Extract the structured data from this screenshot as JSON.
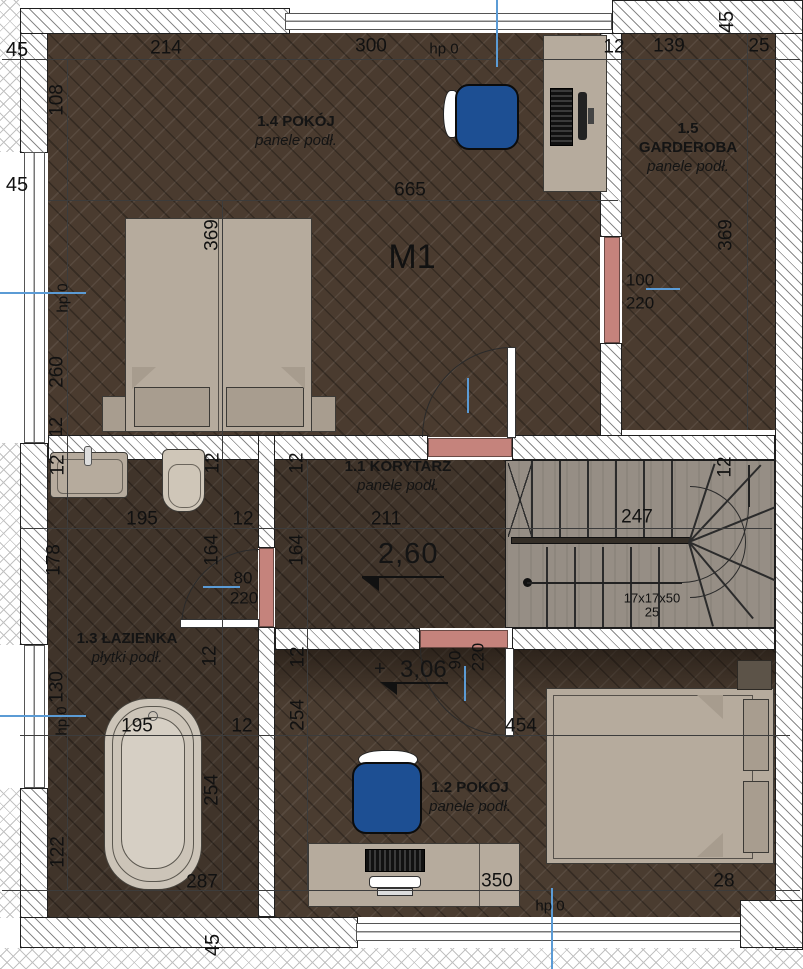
{
  "plan": {
    "title": "M1",
    "rooms": [
      {
        "name": "1.4 POKÓJ",
        "floor": "panele podł.",
        "cx": 296,
        "cy": 113,
        "w": 170
      },
      {
        "name": "1.5 GARDEROBA",
        "floor": "panele podł.",
        "cx": 688,
        "cy": 120,
        "w": 112
      },
      {
        "name": "1.1 KORYTARZ",
        "floor": "panele podł.",
        "cx": 398,
        "cy": 458,
        "w": 170
      },
      {
        "name": "1.3 ŁAZIENKA",
        "floor": "płytki podł.",
        "cx": 127,
        "cy": 630,
        "w": 104
      },
      {
        "name": "1.2 POKÓJ",
        "floor": "panele podł.",
        "cx": 470,
        "cy": 779,
        "w": 170
      }
    ],
    "levels": [
      {
        "value": "2,60",
        "prefix": ""
      },
      {
        "value": "3,06",
        "prefix": "+"
      }
    ],
    "stairs": {
      "note": "17x17x50",
      "note2": "25"
    },
    "colors": {
      "door_accent": "#c5837c",
      "marker_blue": "#5b9bd5",
      "chair_blue": "#1d4f93"
    },
    "dims": [
      {
        "t": "45",
        "x": 17,
        "y": 50,
        "fs": 20
      },
      {
        "t": "214",
        "x": 166,
        "y": 48
      },
      {
        "t": "300",
        "x": 371,
        "y": 46
      },
      {
        "t": "hp 0",
        "x": 444,
        "y": 49,
        "fs": 15
      },
      {
        "t": "12",
        "x": 614,
        "y": 47
      },
      {
        "t": "139",
        "x": 669,
        "y": 46
      },
      {
        "t": "25",
        "x": 759,
        "y": 46
      },
      {
        "t": "45",
        "x": 727,
        "y": 22,
        "r": 1,
        "fs": 20
      },
      {
        "t": "108",
        "x": 57,
        "y": 100,
        "r": 1
      },
      {
        "t": "45",
        "x": 17,
        "y": 185,
        "fs": 20
      },
      {
        "t": "hp 0",
        "x": 63,
        "y": 298,
        "r": 1,
        "fs": 15
      },
      {
        "t": "260",
        "x": 57,
        "y": 372,
        "r": 1
      },
      {
        "t": "12",
        "x": 56,
        "y": 427,
        "r": 1,
        "fs": 18
      },
      {
        "t": "665",
        "x": 410,
        "y": 190
      },
      {
        "t": "369",
        "x": 212,
        "y": 235,
        "r": 1
      },
      {
        "t": "369",
        "x": 726,
        "y": 235,
        "r": 1
      },
      {
        "t": "100",
        "x": 640,
        "y": 280,
        "fs": 17
      },
      {
        "t": "220",
        "x": 640,
        "y": 303,
        "fs": 17
      },
      {
        "t": "12",
        "x": 58,
        "y": 465,
        "r": 1
      },
      {
        "t": "12",
        "x": 213,
        "y": 463,
        "r": 1
      },
      {
        "t": "12",
        "x": 297,
        "y": 463,
        "r": 1
      },
      {
        "t": "12",
        "x": 725,
        "y": 467,
        "r": 1
      },
      {
        "t": "195",
        "x": 142,
        "y": 519
      },
      {
        "t": "12",
        "x": 243,
        "y": 519
      },
      {
        "t": "211",
        "x": 386,
        "y": 519
      },
      {
        "t": "247",
        "x": 637,
        "y": 517
      },
      {
        "t": "178",
        "x": 54,
        "y": 560,
        "r": 1
      },
      {
        "t": "164",
        "x": 212,
        "y": 550,
        "r": 1
      },
      {
        "t": "164",
        "x": 297,
        "y": 550,
        "r": 1
      },
      {
        "t": "80",
        "x": 243,
        "y": 578,
        "fs": 17
      },
      {
        "t": "220",
        "x": 244,
        "y": 598,
        "fs": 17
      },
      {
        "t": "17x17x50",
        "x": 652,
        "y": 598,
        "fs": 13
      },
      {
        "t": "25",
        "x": 652,
        "y": 612,
        "fs": 13
      },
      {
        "t": "12",
        "x": 210,
        "y": 656,
        "r": 1
      },
      {
        "t": "12",
        "x": 298,
        "y": 657,
        "r": 1
      },
      {
        "t": "130",
        "x": 57,
        "y": 687,
        "r": 1
      },
      {
        "t": "hp 0",
        "x": 62,
        "y": 721,
        "r": 1,
        "fs": 15
      },
      {
        "t": "254",
        "x": 298,
        "y": 715,
        "r": 1
      },
      {
        "t": "90",
        "x": 455,
        "y": 660,
        "r": 1,
        "fs": 17
      },
      {
        "t": "220",
        "x": 478,
        "y": 657,
        "r": 1,
        "fs": 17
      },
      {
        "t": "195",
        "x": 137,
        "y": 726
      },
      {
        "t": "12",
        "x": 242,
        "y": 726
      },
      {
        "t": "454",
        "x": 521,
        "y": 726
      },
      {
        "t": "254",
        "x": 212,
        "y": 790,
        "r": 1
      },
      {
        "t": "122",
        "x": 58,
        "y": 852,
        "r": 1
      },
      {
        "t": "287",
        "x": 202,
        "y": 882
      },
      {
        "t": "350",
        "x": 497,
        "y": 881
      },
      {
        "t": "28",
        "x": 724,
        "y": 881
      },
      {
        "t": "hp 0",
        "x": 550,
        "y": 906,
        "fs": 15
      },
      {
        "t": "45",
        "x": 213,
        "y": 945,
        "r": 1,
        "fs": 20
      }
    ]
  }
}
